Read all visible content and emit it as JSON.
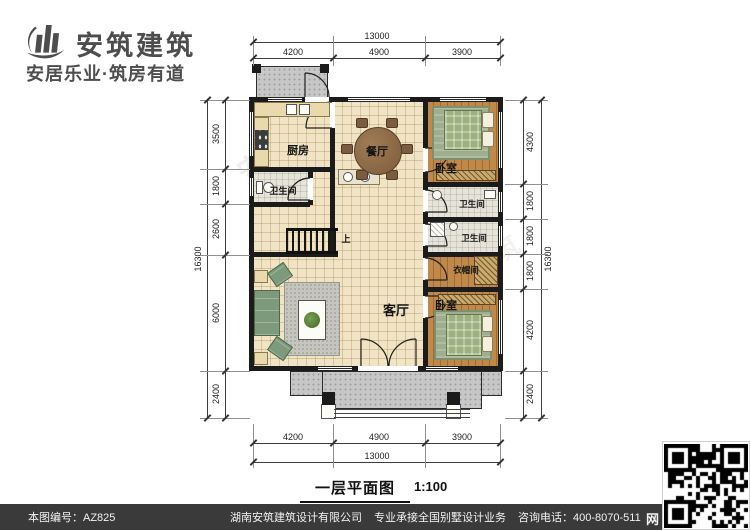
{
  "header": {
    "logo_text": "安筑建筑",
    "tagline": "安居乐业·筑房有道"
  },
  "title": {
    "name": "一层平面图",
    "scale": "1:100"
  },
  "plan": {
    "rooms": {
      "kitchen": "厨房",
      "bath_left": "卫生间",
      "dining": "餐厅",
      "bedroom_top": "卧室",
      "bath_right_1": "卫生间",
      "bath_right_2": "卫生间",
      "cloakroom": "衣帽间",
      "living": "客厅",
      "bedroom_bottom": "卧室",
      "stairs_up": "上"
    },
    "dims": {
      "top_total": "13000",
      "top_segments": [
        "4200",
        "4900",
        "3900"
      ],
      "bottom_segments": [
        "4200",
        "4900",
        "3900"
      ],
      "bottom_total": "13000",
      "left_total": "16300",
      "left_segments": [
        "3500",
        "1800",
        "2600",
        "6000",
        "2400"
      ],
      "right_segments": [
        "4300",
        "1800",
        "1800",
        "1800",
        "4200",
        "2400"
      ],
      "right_total": "16300"
    }
  },
  "watermark": {
    "cn": "安筑建筑",
    "en": "anaz.jz.com"
  },
  "footer": {
    "drawing_no": "本图编号：AZ825",
    "company": "湖南安筑建筑设计有限公司",
    "business": "专业承接全国别墅设计业务",
    "phone": "咨询电话：400-8070-511",
    "web": "网"
  },
  "colors": {
    "wall": "#1b1b1b",
    "floor_tile": "#f1e4c4",
    "wood_floor": "#c0894a",
    "porch_gray": "#c7c7c7",
    "footer_bar": "#3a3a3a"
  }
}
